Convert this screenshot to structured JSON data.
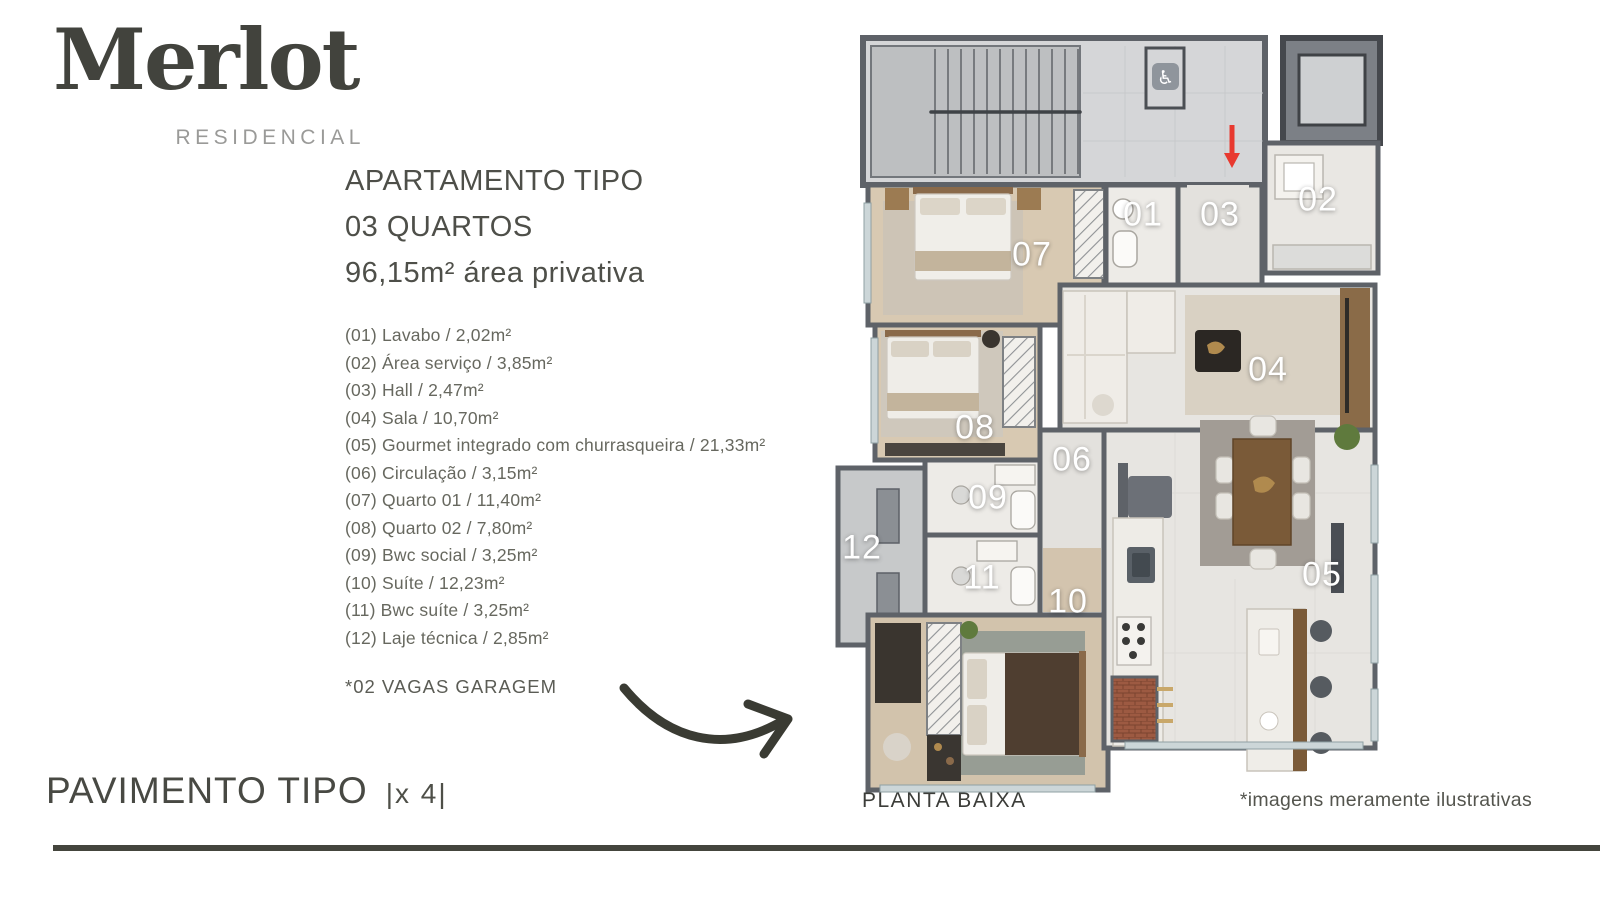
{
  "brand": {
    "name": "Merlot",
    "subtitle": "RESIDENCIAL"
  },
  "apartment": {
    "title_line1": "APARTAMENTO TIPO",
    "title_line2": "03 QUARTOS",
    "title_line3": "96,15m² área privativa"
  },
  "room_list": [
    "(01) Lavabo / 2,02m²",
    "(02) Área serviço / 3,85m²",
    "(03) Hall / 2,47m²",
    "(04) Sala / 10,70m²",
    "(05) Gourmet integrado com churrasqueira / 21,33m²",
    "(06) Circulação / 3,15m²",
    "(07) Quarto 01 / 11,40m²",
    "(08) Quarto 02 / 7,80m²",
    "(09) Bwc social / 3,25m²",
    "(10) Suíte / 12,23m²",
    "(11) Bwc suíte / 3,25m²",
    "(12) Laje técnica / 2,85m²"
  ],
  "garage_note": "*02 VAGAS GARAGEM",
  "pavement": {
    "title": "PAVIMENTO TIPO",
    "multiplier": "|x 4|"
  },
  "plan": {
    "caption": "PLANTA BAIXA",
    "labels": [
      "01",
      "02",
      "03",
      "04",
      "05",
      "06",
      "07",
      "08",
      "09",
      "10",
      "11",
      "12"
    ],
    "accessible_icon_glyph": "♿"
  },
  "disclaimer": "*imagens meramente ilustrativas",
  "colors": {
    "text_dark": "#4a4b44",
    "divider_bar": "#44453d",
    "entry_arrow_red": "#e8392f",
    "wall_gray": "#5e6268",
    "wood_floor": "#d8c9b2",
    "tile_floor": "#e7e5e1",
    "common_hall": "#d5d6d8"
  }
}
